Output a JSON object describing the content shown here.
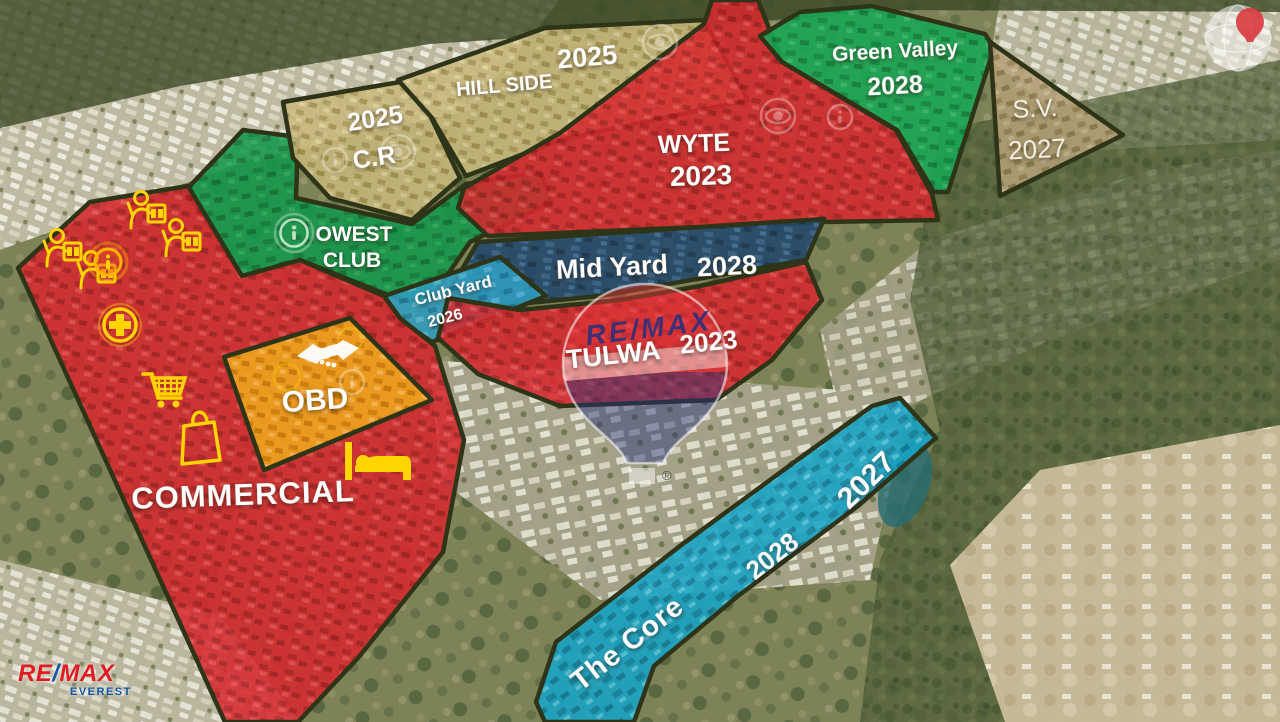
{
  "zones": {
    "hill_side": {
      "name": "HILL SIDE",
      "year": "2025",
      "color": "#c9b87a"
    },
    "cr": {
      "name": "C.R",
      "year": "2025",
      "color": "#c9b87a"
    },
    "owest_club": {
      "name_line1": "OWEST",
      "name_line2": "CLUB",
      "color": "#12984b"
    },
    "green_valley": {
      "name": "Green Valley",
      "year": "2028",
      "color": "#16a855"
    },
    "sv": {
      "name": "S.V.",
      "year": "2027",
      "color": "#b3a077"
    },
    "wyte": {
      "name": "WYTE",
      "year": "2023",
      "color": "#d7282d"
    },
    "mid_yard": {
      "name": "Mid Yard",
      "year": "2028",
      "color": "#20456b"
    },
    "club_yard": {
      "name": "Club Yard",
      "year": "2026",
      "color": "#2f9ec2"
    },
    "tulwa": {
      "name": "TULWA",
      "year": "2023",
      "color": "#d7282d"
    },
    "obd": {
      "name": "OBD",
      "color": "#f0a81c"
    },
    "commercial": {
      "name": "COMMERCIAL",
      "color": "#d7282d"
    },
    "the_core": {
      "name": "The Core",
      "year_a": "2028",
      "year_b": "2027",
      "color": "#16a5c8"
    }
  },
  "watermarks": {
    "center_balloon": {
      "brand": "RE/MAX",
      "registered": "®"
    },
    "corner_logo": {
      "re": "RE",
      "slash": "/",
      "max": "MAX",
      "sub": "EVEREST"
    },
    "top_right_globe": {
      "icon": "remax-balloon-globe"
    }
  },
  "icons": {
    "commercial_zone": [
      "real-estate-agent",
      "real-estate-agent",
      "real-estate-agent",
      "real-estate-agent",
      "info",
      "medical-cross",
      "shopping-cart",
      "shopping-bag",
      "hotel-bed"
    ],
    "obd_zone": [
      "handshake",
      "info",
      "coin-ring"
    ],
    "owest_zone": [
      "info"
    ],
    "wyte_zone": [
      "eye",
      "info"
    ],
    "hill_side_zone": [
      "eye"
    ],
    "cr_zone": [
      "info",
      "eye"
    ]
  },
  "colors": {
    "icon_yellow": "#ffd400",
    "label_white": "#ffffff",
    "remax_red": "#e11b22",
    "remax_blue": "#1155a5",
    "balloon_brand_text": "#2b2f7e"
  }
}
